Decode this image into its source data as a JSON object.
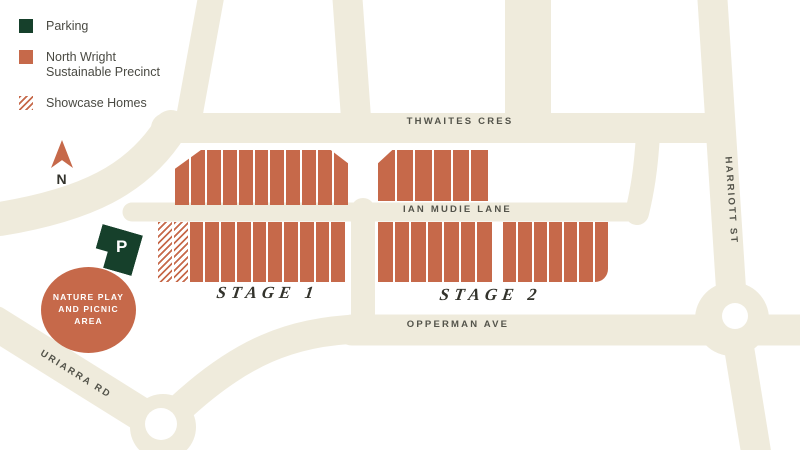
{
  "colors": {
    "road": "#EFEBDC",
    "lot": "#C6694A",
    "parking": "#16402B",
    "label_text": "#53534A",
    "background": "#FFFFFF"
  },
  "legend": {
    "items": [
      {
        "id": "parking",
        "label": "Parking",
        "swatch": "solid-green"
      },
      {
        "id": "precinct",
        "label": "North Wright Sustainable Precinct",
        "swatch": "solid-terracotta"
      },
      {
        "id": "showcase",
        "label": "Showcase Homes",
        "swatch": "hatched"
      }
    ]
  },
  "compass": {
    "label": "N"
  },
  "parking_marker": {
    "label": "P"
  },
  "nature_area": {
    "lines": [
      "NATURE PLAY",
      "AND PICNIC",
      "AREA"
    ]
  },
  "streets": {
    "thwaites": {
      "label": "THWAITES CRES"
    },
    "ian_mudie": {
      "label": "IAN MUDIE LANE"
    },
    "opperman": {
      "label": "OPPERMAN AVE"
    },
    "uriarra": {
      "label": "URIARRA RD"
    },
    "harriott": {
      "label": "HARRIOTT ST"
    }
  },
  "stages": {
    "stage1": {
      "label": "STAGE 1"
    },
    "stage2": {
      "label": "STAGE 2"
    }
  },
  "blocks": [
    {
      "id": "stage1-north",
      "x": 175,
      "y": 150,
      "w": 173,
      "h": 55,
      "lots": 11,
      "hatched": 0,
      "clip": "polygon(0 100%, 0 34%, 15% 0, 90% 0, 100% 24%, 100% 100%)",
      "round_br": 0
    },
    {
      "id": "stage2-north",
      "x": 378,
      "y": 150,
      "w": 110,
      "h": 51,
      "lots": 6,
      "hatched": 0,
      "clip": "polygon(0 100%, 0 26%, 13% 0, 100% 0, 100% 100%)",
      "round_br": 0
    },
    {
      "id": "stage1-south",
      "x": 158,
      "y": 222,
      "w": 187,
      "h": 60,
      "lots": 12,
      "hatched": 2,
      "clip": "",
      "round_br": 0
    },
    {
      "id": "stage2-south-west",
      "x": 378,
      "y": 222,
      "w": 114,
      "h": 60,
      "lots": 7,
      "hatched": 0,
      "clip": "",
      "round_br": 0
    },
    {
      "id": "stage2-south-east",
      "x": 503,
      "y": 222,
      "w": 105,
      "h": 60,
      "lots": 7,
      "hatched": 0,
      "clip": "",
      "round_br": 18
    }
  ]
}
